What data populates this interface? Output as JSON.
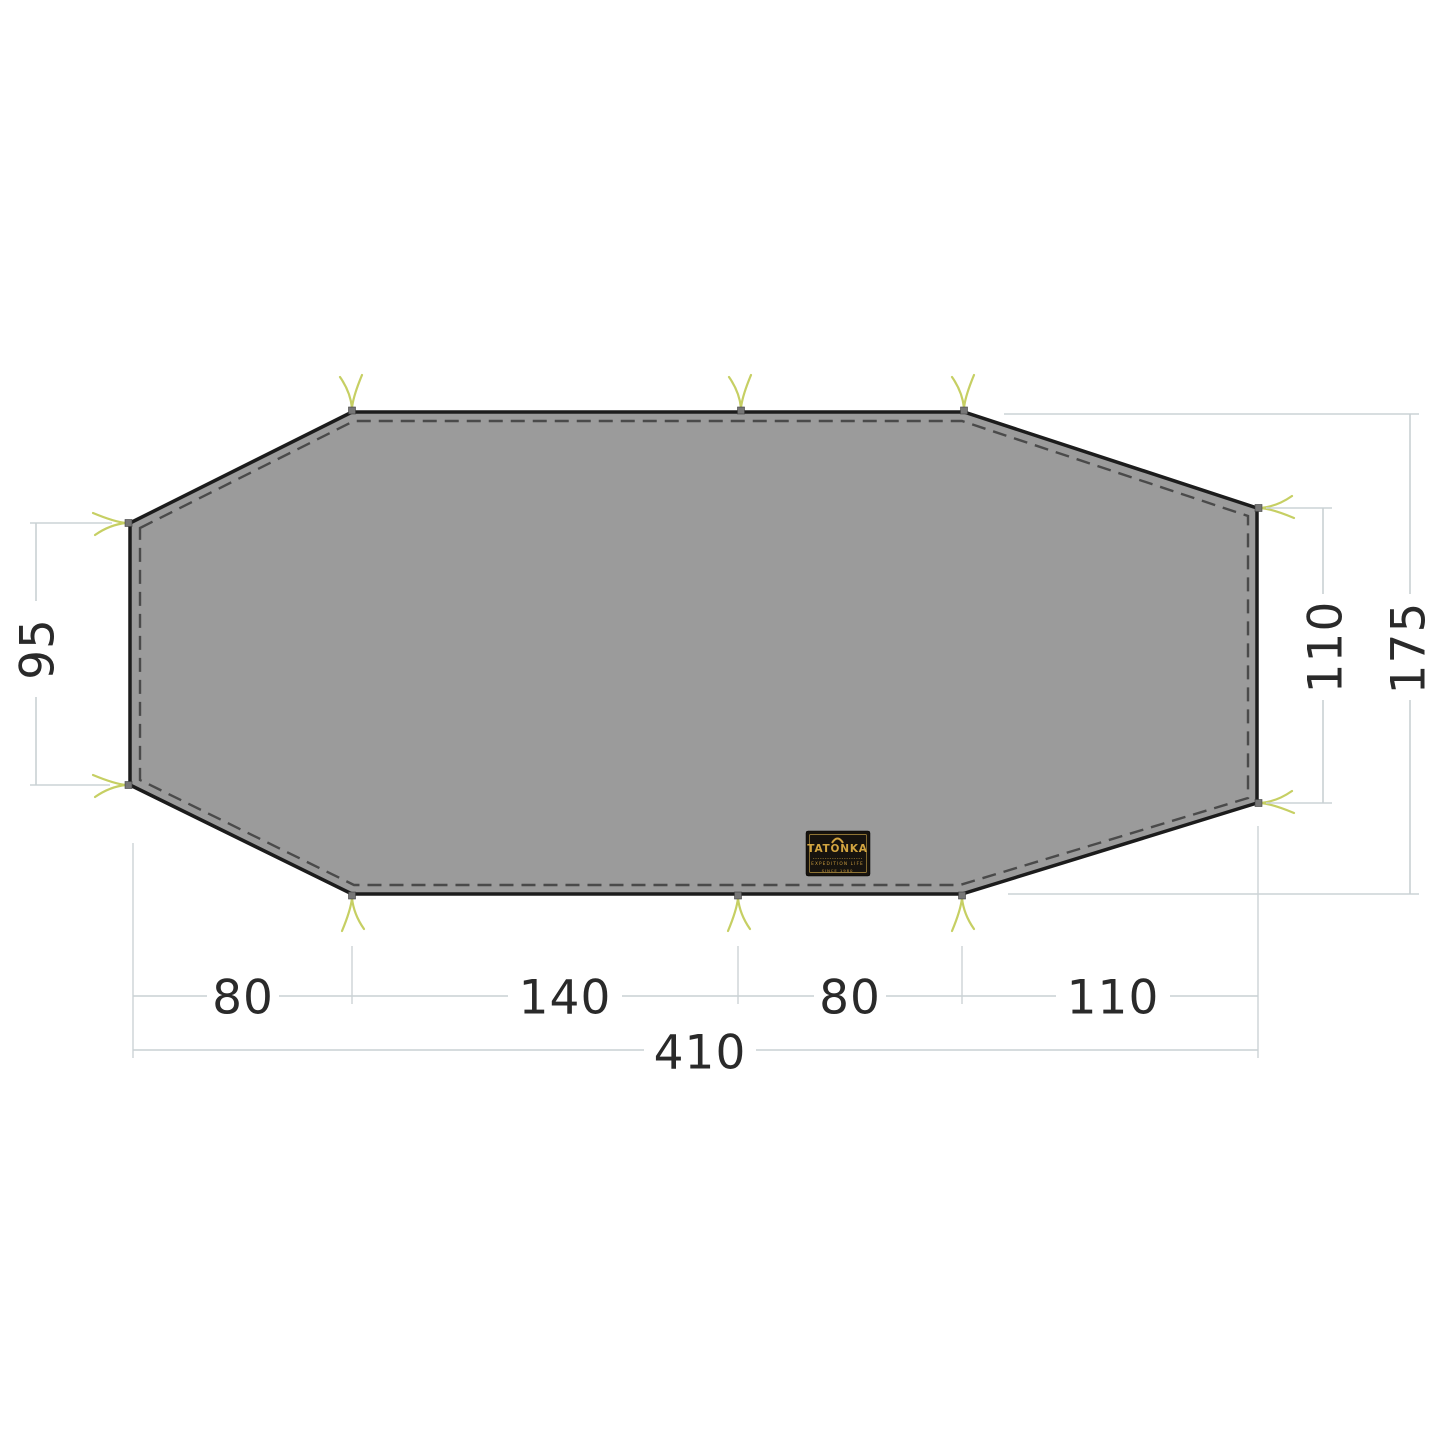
{
  "drawing": {
    "type": "tent-footprint-dimension-diagram",
    "vertical_dimensions": {
      "left": "95",
      "right": "110",
      "overall": "175"
    },
    "horizontal_dimensions": {
      "segments": [
        "80",
        "140",
        "80",
        "110"
      ],
      "overall": "410"
    },
    "brand_label": {
      "brand": "TATONKA",
      "tagline": "EXPEDITION LIFE",
      "since": "SINCE 1980"
    },
    "colors": {
      "footprint_fill": "#9b9b9b",
      "outline": "#1c1c1c",
      "seam_dashed": "#4a4a4a",
      "guy_loop_yellow": "#c6cf63",
      "dimension_line": "#c9d1d4",
      "dimension_text": "#2a2a2a",
      "label_background": "#17130e",
      "label_gold": "#d2a440"
    }
  }
}
